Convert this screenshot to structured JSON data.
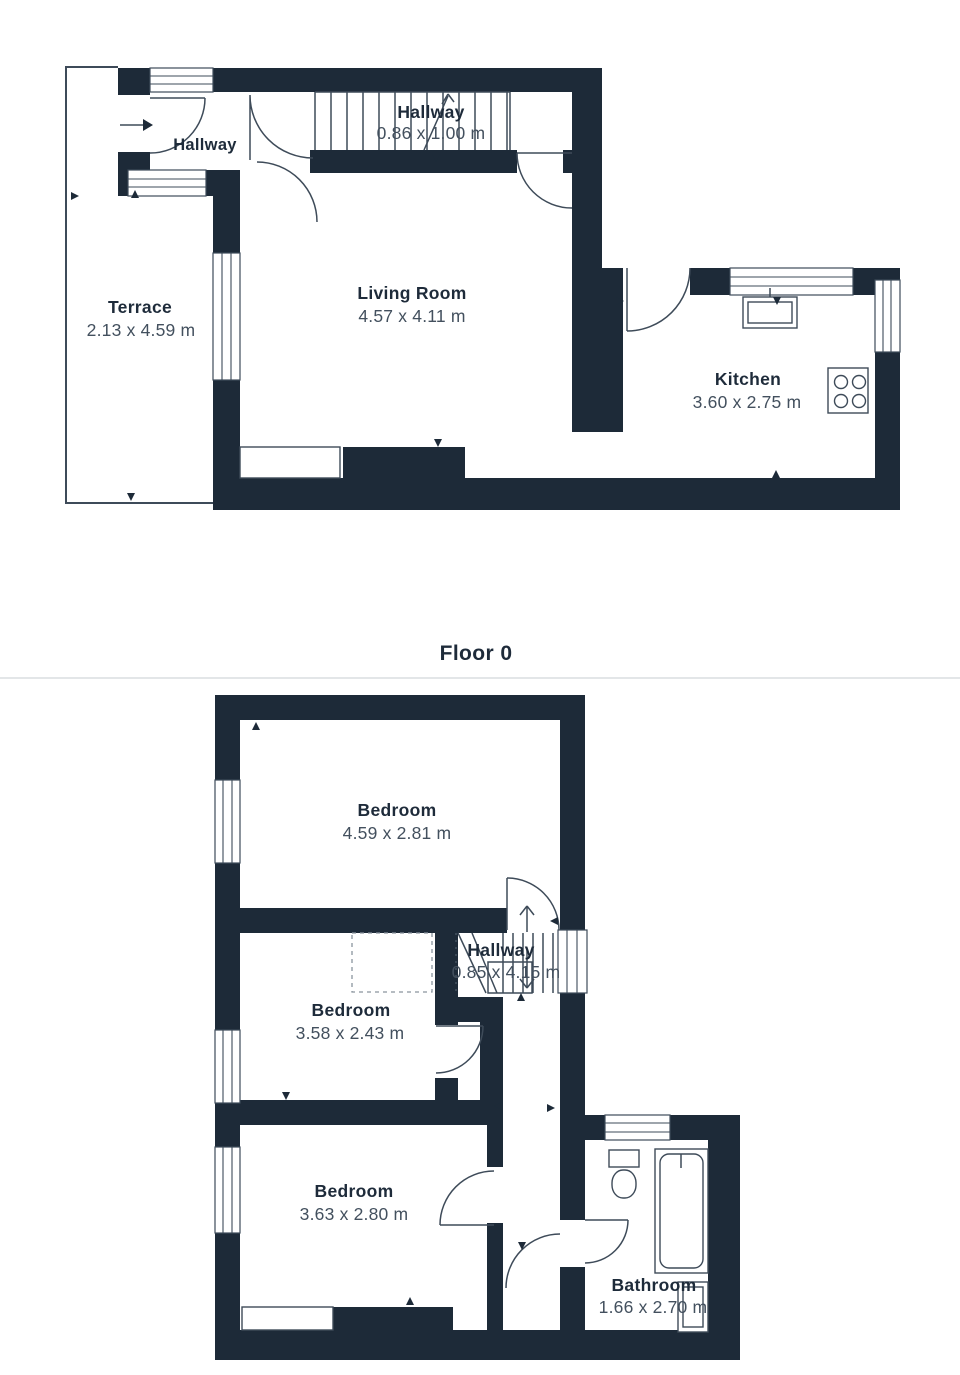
{
  "title": "Floor 0",
  "floor0": {
    "entry_hallway": {
      "name": "Hallway"
    },
    "stair_hallway": {
      "name": "Hallway",
      "dims": "0.86 x 1.00 m"
    },
    "terrace": {
      "name": "Terrace",
      "dims": "2.13 x 4.59 m"
    },
    "living_room": {
      "name": "Living Room",
      "dims": "4.57 x 4.11 m"
    },
    "kitchen": {
      "name": "Kitchen",
      "dims": "3.60 x 2.75 m"
    }
  },
  "floor1": {
    "bedroom_top": {
      "name": "Bedroom",
      "dims": "4.59 x 2.81 m"
    },
    "hallway": {
      "name": "Hallway",
      "dims": "0.85 x 4.15 m"
    },
    "bedroom_middle": {
      "name": "Bedroom",
      "dims": "3.58 x 2.43 m"
    },
    "bedroom_bottom": {
      "name": "Bedroom",
      "dims": "3.63 x 2.80 m"
    },
    "bathroom": {
      "name": "Bathroom",
      "dims": "1.66 x 2.70 m"
    }
  },
  "colors": {
    "wall": "#1d2a38",
    "line": "#3e4b59",
    "text": "#1e2b3a",
    "dims": "#43505e",
    "divider": "#dadde0"
  }
}
